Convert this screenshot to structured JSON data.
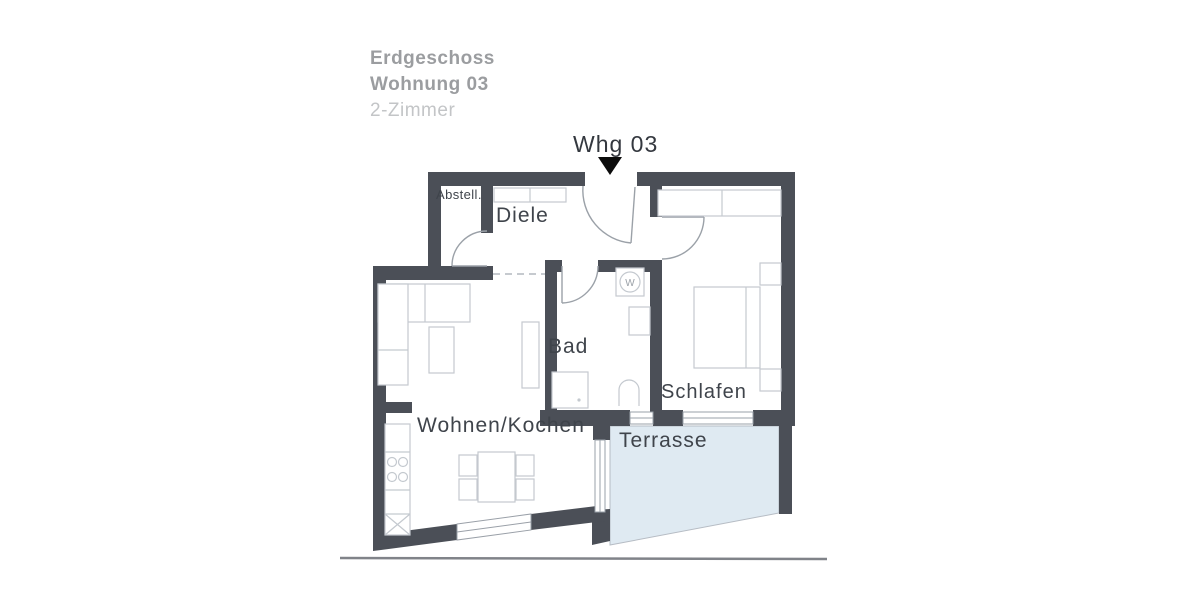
{
  "header": {
    "line1": "Erdgeschoss",
    "line2": "Wohnung 03",
    "line3": "2-Zimmer"
  },
  "plan": {
    "entrance_label": "Whg 03",
    "rooms": {
      "abstell": "Abstell.",
      "diele": "Diele",
      "bad": "Bad",
      "schlafen": "Schlafen",
      "wohnen": "Wohnen/Kochen",
      "terrasse": "Terrasse"
    },
    "symbols": {
      "washer": "W"
    },
    "colors": {
      "wall": "#4b4f57",
      "door_line": "#9ba1a8",
      "furniture_line": "#c4c9cf",
      "window_line": "#9aa0a8",
      "terrace_fill": "#dfeaf2",
      "room_label_text": "#3f444b",
      "header_text": "#9b9da0",
      "header_muted_text": "#c3c5c7",
      "entrance_marker": "#0c0c0c",
      "scan_edge_line": "#808389"
    }
  }
}
